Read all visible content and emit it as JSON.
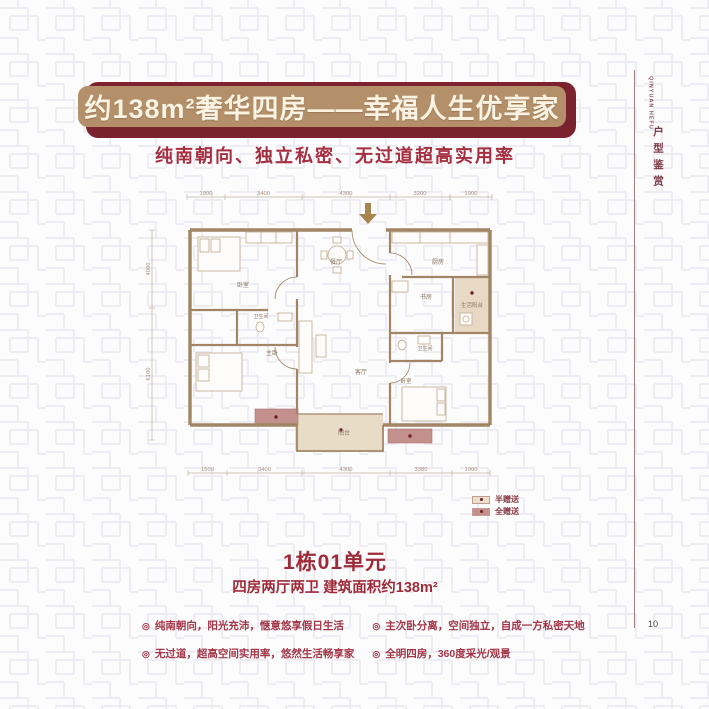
{
  "header": {
    "title": "约138m²奢华四房——幸福人生优享家",
    "subtitle": "纯南朝向、独立私密、无过道超高实用率"
  },
  "floorplan": {
    "rooms": [
      "卧室",
      "餐厅",
      "厨房",
      "书房",
      "生活阳台",
      "卫生间",
      "主卧",
      "客厅",
      "卫生间",
      "卧室",
      "阳台"
    ],
    "dims_top": [
      "1900",
      "3400",
      "4300",
      "3200",
      "1900"
    ],
    "dims_bottom": [
      "1500",
      "3400",
      "4300",
      "3380",
      "1900"
    ],
    "dims_left": [
      "4000",
      "6100"
    ],
    "legend": [
      {
        "label": "半赠送",
        "color": "#ecdfcb"
      },
      {
        "label": "全赠送",
        "color": "#c4908d"
      }
    ]
  },
  "unit": {
    "name": "1栋01单元",
    "spec": "四房两厅两卫 建筑面积约138m²"
  },
  "features": {
    "marker": "◎",
    "left": [
      "纯南朝向，阳光充沛，惬意悠享假日生活",
      "无过道，超高空间实用率，悠然生活畅享家"
    ],
    "right": [
      "主次卧分离，空间独立，自成一方私密天地",
      "全明四房，360度采光/观景"
    ]
  },
  "sidebar": {
    "en": "QINYUAN HEFU",
    "cn": "户型鉴赏",
    "page_number": "10"
  },
  "colors": {
    "banner_front": "#b3906a",
    "banner_back": "#7a222e",
    "accent_red": "#a52e40",
    "wall": "#a28565",
    "half_gift": "#ecdfcb",
    "full_gift": "#c4908d"
  }
}
